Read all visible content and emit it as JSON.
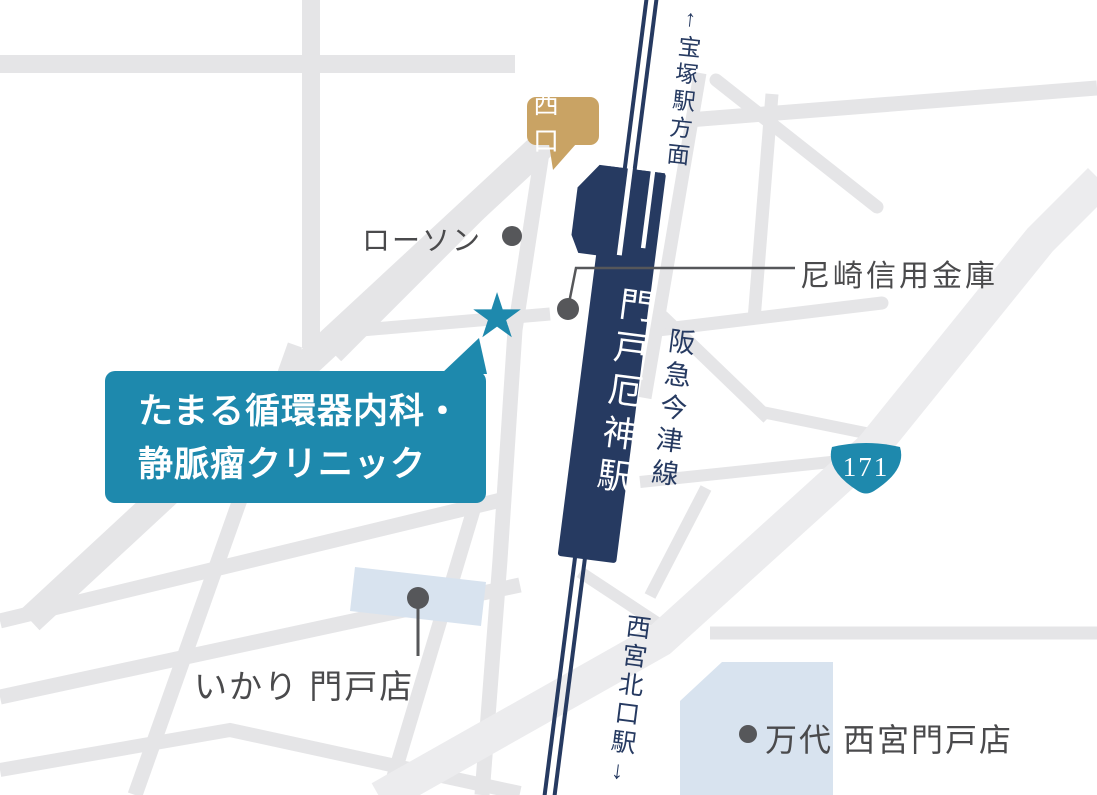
{
  "colors": {
    "navy": "#263a61",
    "teal": "#1e89ad",
    "tan": "#c9a364",
    "road": "#e5e5e7",
    "road_major": "#ececee",
    "building": "#d8e3ef",
    "text_gray": "#4a4a4c",
    "marker_gray": "#56575a",
    "bg": "#ffffff"
  },
  "labels": {
    "west_exit": "西口",
    "direction_takarazuka": "↑宝塚駅方面",
    "lawson": "ローソン",
    "bank": "尼崎信用金庫",
    "station": "門戸厄神駅",
    "line": "阪急今津線",
    "clinic_line1": "たまる循環器内科・",
    "clinic_line2": "静脈瘤クリニック",
    "route_number": "171",
    "ikari": "いかり 門戸店",
    "direction_nishinomiya": "西宮北口駅↓",
    "mandai": "万代 西宮門戸店",
    "star": "★"
  }
}
